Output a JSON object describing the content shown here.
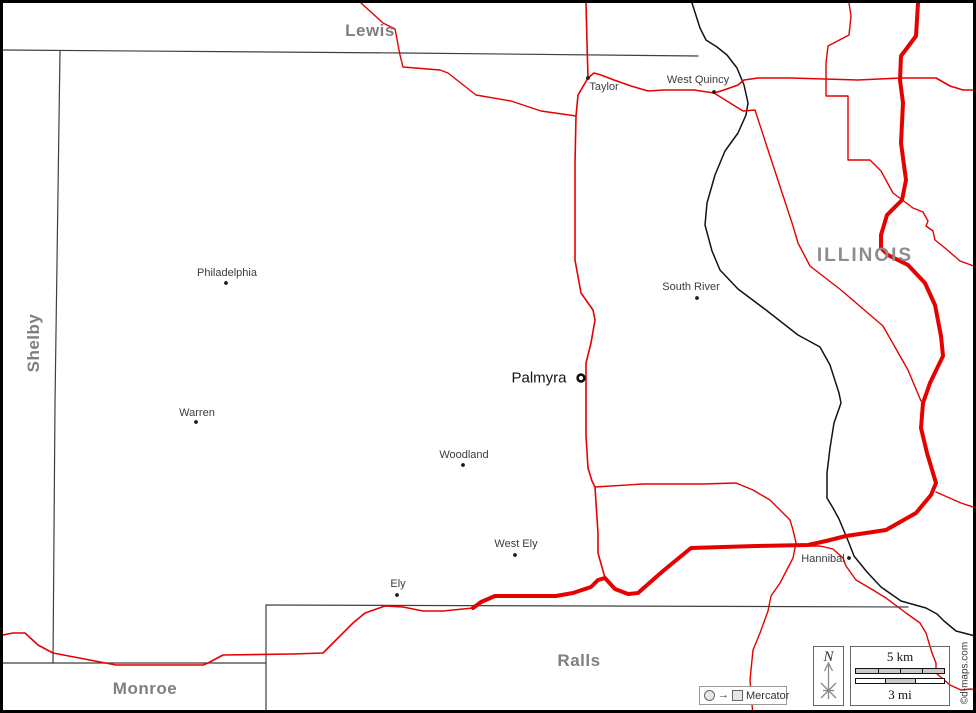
{
  "colors": {
    "road": "#e60000",
    "county_border": "#3f3f3f",
    "state_border": "#141414",
    "county_label": "#7f7f7f",
    "town_label": "#3c3c3c",
    "frame": "#000000"
  },
  "region_labels": [
    {
      "id": "lewis",
      "name": "Lewis",
      "x": 367,
      "y": 28,
      "kind": "county",
      "rotated": false
    },
    {
      "id": "shelby",
      "name": "Shelby",
      "x": 31,
      "y": 340,
      "kind": "county",
      "rotated": true
    },
    {
      "id": "monroe",
      "name": "Monroe",
      "x": 142,
      "y": 686,
      "kind": "county",
      "rotated": false
    },
    {
      "id": "ralls",
      "name": "Ralls",
      "x": 576,
      "y": 658,
      "kind": "county",
      "rotated": false
    },
    {
      "id": "illinois",
      "name": "ILLINOIS",
      "x": 862,
      "y": 253,
      "kind": "state",
      "rotated": false
    }
  ],
  "towns": [
    {
      "name": "Taylor",
      "label_x": 601,
      "label_y": 84,
      "dot_x": 585,
      "dot_y": 75,
      "seat": false
    },
    {
      "name": "West Quincy",
      "label_x": 695,
      "label_y": 77,
      "dot_x": 711,
      "dot_y": 89,
      "seat": false
    },
    {
      "name": "Philadelphia",
      "label_x": 224,
      "label_y": 270,
      "dot_x": 223,
      "dot_y": 280,
      "seat": false
    },
    {
      "name": "Warren",
      "label_x": 194,
      "label_y": 410,
      "dot_x": 193,
      "dot_y": 419,
      "seat": false
    },
    {
      "name": "Woodland",
      "label_x": 461,
      "label_y": 452,
      "dot_x": 460,
      "dot_y": 462,
      "seat": false
    },
    {
      "name": "South River",
      "label_x": 688,
      "label_y": 284,
      "dot_x": 694,
      "dot_y": 295,
      "seat": false
    },
    {
      "name": "West Ely",
      "label_x": 513,
      "label_y": 541,
      "dot_x": 512,
      "dot_y": 552,
      "seat": false
    },
    {
      "name": "Ely",
      "label_x": 395,
      "label_y": 581,
      "dot_x": 394,
      "dot_y": 592,
      "seat": false
    },
    {
      "name": "Hannibal",
      "label_x": 820,
      "label_y": 556,
      "dot_x": 846,
      "dot_y": 555,
      "seat": false
    },
    {
      "name": "Palmyra",
      "label_x": 536,
      "label_y": 375,
      "dot_x": 578,
      "dot_y": 375,
      "seat": true
    }
  ],
  "county_borders": [
    {
      "name": "lewis-marion-line",
      "points": [
        [
          0,
          47
        ],
        [
          400,
          50
        ],
        [
          695,
          53
        ]
      ]
    },
    {
      "name": "shelby-marion-line",
      "points": [
        [
          57,
          48
        ],
        [
          52,
          400
        ],
        [
          50,
          660
        ]
      ]
    },
    {
      "name": "monroe-marion-line",
      "points": [
        [
          0,
          660
        ],
        [
          263,
          660
        ]
      ]
    },
    {
      "name": "monroe-ralls-line",
      "points": [
        [
          263,
          602
        ],
        [
          263,
          713
        ]
      ]
    },
    {
      "name": "ralls-marion-line",
      "points": [
        [
          263,
          602
        ],
        [
          600,
          603
        ],
        [
          905,
          604
        ]
      ]
    }
  ],
  "state_border": {
    "name": "mississippi-river-state-line",
    "points": [
      [
        689,
        0
      ],
      [
        697,
        25
      ],
      [
        703,
        37
      ],
      [
        714,
        44
      ],
      [
        724,
        52
      ],
      [
        734,
        65
      ],
      [
        741,
        82
      ],
      [
        745,
        100
      ],
      [
        743,
        112
      ],
      [
        735,
        130
      ],
      [
        722,
        148
      ],
      [
        712,
        172
      ],
      [
        704,
        200
      ],
      [
        702,
        222
      ],
      [
        709,
        248
      ],
      [
        717,
        267
      ],
      [
        735,
        286
      ],
      [
        763,
        307
      ],
      [
        795,
        332
      ],
      [
        817,
        344
      ],
      [
        827,
        362
      ],
      [
        836,
        390
      ],
      [
        838,
        400
      ],
      [
        831,
        420
      ],
      [
        827,
        445
      ],
      [
        824,
        470
      ],
      [
        824,
        495
      ],
      [
        830,
        505
      ],
      [
        836,
        516
      ],
      [
        841,
        528
      ],
      [
        846,
        540
      ],
      [
        851,
        553
      ],
      [
        864,
        569
      ],
      [
        878,
        584
      ],
      [
        898,
        598
      ],
      [
        923,
        605
      ],
      [
        934,
        611
      ],
      [
        941,
        618
      ],
      [
        953,
        628
      ],
      [
        976,
        634
      ]
    ]
  },
  "roads": [
    {
      "name": "road-northwest",
      "width": 1.4,
      "points": [
        [
          358,
          0
        ],
        [
          380,
          20
        ],
        [
          392,
          26
        ],
        [
          397,
          52
        ],
        [
          400,
          64
        ],
        [
          437,
          67
        ],
        [
          445,
          70
        ],
        [
          473,
          92
        ],
        [
          508,
          98
        ],
        [
          538,
          108
        ],
        [
          573,
          113
        ]
      ]
    },
    {
      "name": "road-taylor-palmyra",
      "width": 1.6,
      "points": [
        [
          583,
          0
        ],
        [
          584,
          40
        ],
        [
          585,
          75
        ],
        [
          575,
          92
        ],
        [
          573,
          113
        ],
        [
          572,
          160
        ],
        [
          572,
          257
        ],
        [
          578,
          290
        ],
        [
          590,
          307
        ],
        [
          592,
          317
        ],
        [
          588,
          340
        ],
        [
          583,
          360
        ],
        [
          583,
          377
        ],
        [
          583,
          433
        ],
        [
          585,
          465
        ],
        [
          589,
          478
        ],
        [
          592,
          484
        ],
        [
          593,
          500
        ],
        [
          595,
          530
        ],
        [
          595,
          550
        ],
        [
          602,
          575
        ]
      ]
    },
    {
      "name": "road-taylor-west-quincy-east",
      "width": 1.6,
      "points": [
        [
          585,
          75
        ],
        [
          591,
          70
        ],
        [
          598,
          72
        ],
        [
          611,
          77
        ],
        [
          628,
          83
        ],
        [
          645,
          88
        ],
        [
          661,
          87
        ],
        [
          678,
          87
        ],
        [
          691,
          87
        ],
        [
          711,
          90
        ],
        [
          721,
          87
        ],
        [
          735,
          82
        ],
        [
          741,
          77
        ],
        [
          755,
          75
        ],
        [
          788,
          75
        ],
        [
          855,
          77
        ],
        [
          898,
          75
        ],
        [
          933,
          75
        ],
        [
          947,
          83
        ],
        [
          960,
          87
        ],
        [
          976,
          87
        ]
      ]
    },
    {
      "name": "highway-thick",
      "width": 4.0,
      "points": [
        [
          915,
          0
        ],
        [
          913,
          33
        ],
        [
          898,
          53
        ],
        [
          897,
          77
        ],
        [
          900,
          100
        ],
        [
          898,
          140
        ],
        [
          903,
          177
        ],
        [
          899,
          197
        ],
        [
          884,
          212
        ],
        [
          878,
          232
        ],
        [
          878,
          245
        ],
        [
          885,
          252
        ],
        [
          905,
          262
        ],
        [
          922,
          280
        ],
        [
          932,
          302
        ],
        [
          938,
          333
        ],
        [
          940,
          353
        ],
        [
          927,
          380
        ],
        [
          920,
          400
        ],
        [
          918,
          425
        ],
        [
          924,
          450
        ],
        [
          933,
          480
        ],
        [
          928,
          492
        ],
        [
          913,
          510
        ],
        [
          883,
          527
        ],
        [
          863,
          530
        ],
        [
          843,
          533
        ],
        [
          823,
          538
        ],
        [
          805,
          542
        ],
        [
          753,
          543
        ],
        [
          688,
          545
        ],
        [
          660,
          568
        ],
        [
          635,
          590
        ],
        [
          625,
          591
        ],
        [
          612,
          586
        ],
        [
          602,
          575
        ],
        [
          595,
          577
        ],
        [
          588,
          584
        ],
        [
          570,
          590
        ],
        [
          553,
          593
        ],
        [
          492,
          593
        ],
        [
          478,
          599
        ],
        [
          470,
          605
        ]
      ]
    },
    {
      "name": "road-west-along-ralls",
      "width": 1.6,
      "points": [
        [
          470,
          605
        ],
        [
          440,
          608
        ],
        [
          420,
          608
        ],
        [
          400,
          604
        ],
        [
          382,
          603
        ],
        [
          362,
          610
        ],
        [
          350,
          620
        ],
        [
          332,
          638
        ],
        [
          325,
          645
        ],
        [
          320,
          650
        ],
        [
          290,
          651
        ],
        [
          220,
          652
        ],
        [
          205,
          660
        ],
        [
          200,
          662
        ],
        [
          113,
          662
        ],
        [
          50,
          650
        ],
        [
          35,
          642
        ],
        [
          22,
          630
        ],
        [
          10,
          630
        ],
        [
          0,
          632
        ]
      ]
    },
    {
      "name": "road-palmyra-east-loop",
      "width": 1.4,
      "points": [
        [
          592,
          484
        ],
        [
          640,
          481
        ],
        [
          700,
          481
        ],
        [
          733,
          480
        ],
        [
          750,
          487
        ],
        [
          767,
          497
        ],
        [
          777,
          507
        ],
        [
          787,
          517
        ],
        [
          790,
          527
        ],
        [
          793,
          540
        ],
        [
          790,
          555
        ],
        [
          777,
          580
        ],
        [
          768,
          593
        ],
        [
          765,
          608
        ],
        [
          757,
          630
        ],
        [
          750,
          647
        ],
        [
          747,
          677
        ],
        [
          750,
          713
        ]
      ]
    },
    {
      "name": "road-hannibal-southeast",
      "width": 1.4,
      "points": [
        [
          793,
          543
        ],
        [
          817,
          543
        ],
        [
          830,
          546
        ],
        [
          840,
          555
        ],
        [
          843,
          563
        ],
        [
          853,
          577
        ],
        [
          870,
          587
        ],
        [
          883,
          595
        ],
        [
          903,
          610
        ],
        [
          917,
          620
        ],
        [
          923,
          630
        ],
        [
          926,
          640
        ],
        [
          929,
          650
        ],
        [
          933,
          660
        ],
        [
          933,
          670
        ],
        [
          947,
          682
        ],
        [
          958,
          687
        ],
        [
          968,
          686
        ],
        [
          976,
          688
        ]
      ]
    },
    {
      "name": "road-illinois-north",
      "width": 1.4,
      "points": [
        [
          846,
          0
        ],
        [
          848,
          13
        ],
        [
          846,
          32
        ],
        [
          825,
          43
        ],
        [
          823,
          60
        ],
        [
          823,
          93
        ],
        [
          845,
          93
        ],
        [
          845,
          157
        ],
        [
          867,
          157
        ],
        [
          878,
          168
        ],
        [
          890,
          190
        ],
        [
          910,
          205
        ],
        [
          920,
          209
        ],
        [
          925,
          218
        ],
        [
          923,
          223
        ],
        [
          930,
          228
        ],
        [
          932,
          237
        ],
        [
          942,
          245
        ],
        [
          957,
          258
        ],
        [
          976,
          265
        ]
      ]
    },
    {
      "name": "road-illinois-diagonal",
      "width": 1.4,
      "points": [
        [
          711,
          90
        ],
        [
          740,
          108
        ],
        [
          752,
          107
        ],
        [
          767,
          153
        ],
        [
          790,
          223
        ],
        [
          795,
          240
        ],
        [
          807,
          263
        ],
        [
          838,
          287
        ],
        [
          880,
          323
        ],
        [
          905,
          367
        ],
        [
          918,
          398
        ]
      ]
    },
    {
      "name": "road-east-short",
      "width": 1.4,
      "points": [
        [
          933,
          489
        ],
        [
          958,
          500
        ],
        [
          976,
          506
        ]
      ]
    }
  ],
  "north": {
    "label": "N"
  },
  "scale": {
    "km_label": "5 km",
    "mi_label": "3 mi"
  },
  "projection": {
    "arrow": "→",
    "label": "Mercator"
  },
  "copyright": "©d-maps.com"
}
